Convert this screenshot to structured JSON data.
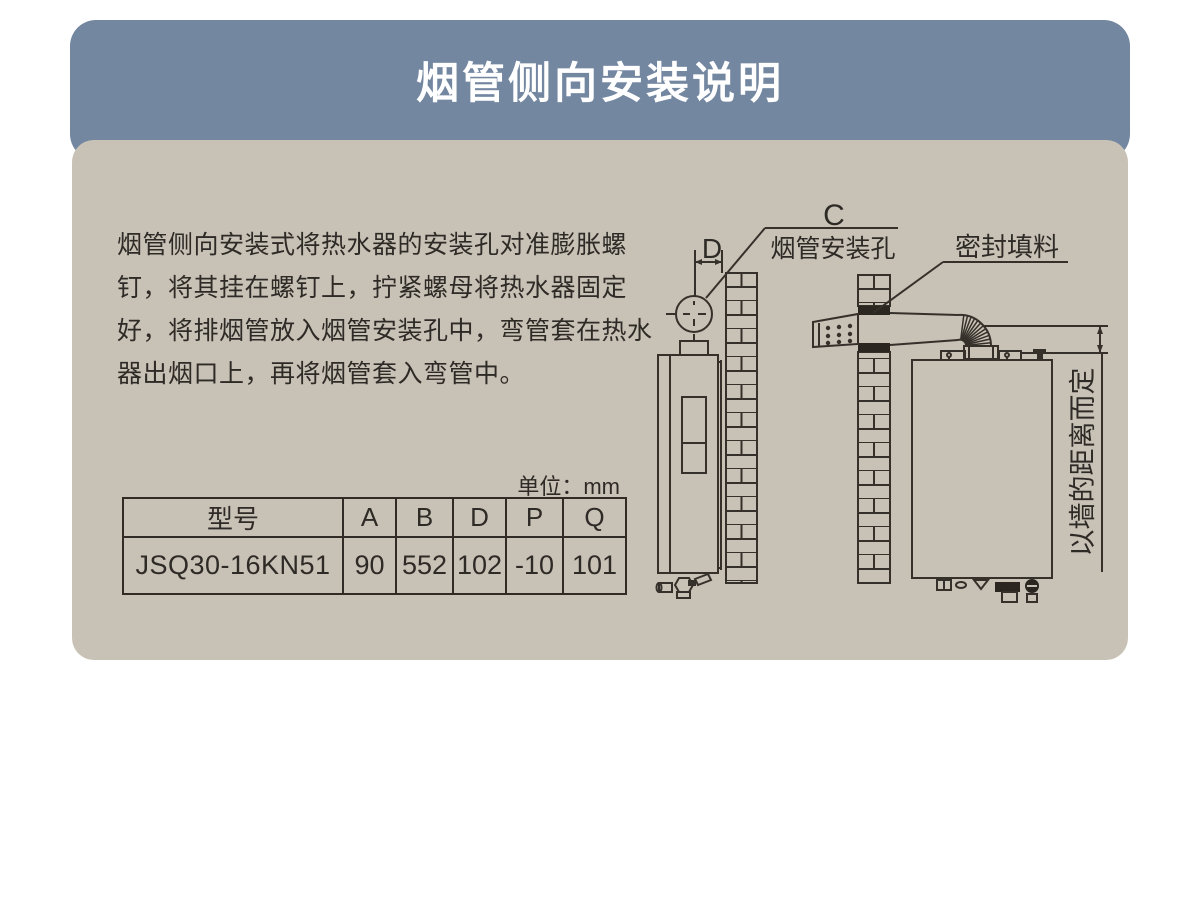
{
  "header": {
    "title": "烟管侧向安装说明",
    "background": "#7487a1",
    "text_color": "#ffffff"
  },
  "body_panel": {
    "background": "#c8c1b6"
  },
  "instructions": "烟管侧向安装式将热水器的安装孔对准膨胀螺钉，将其挂在螺钉上，拧紧螺母将热水器固定好，将排烟管放入烟管安装孔中，弯管套在热水器出烟口上，再将烟管套入弯管中。",
  "spec_table": {
    "unit_label": "单位：mm",
    "columns": [
      "型号",
      "A",
      "B",
      "D",
      "P",
      "Q"
    ],
    "rows": [
      {
        "model": "JSQ30-16KN51",
        "A": "90",
        "B": "552",
        "D": "102",
        "P": "-10",
        "Q": "101"
      }
    ]
  },
  "diagrams": {
    "left": {
      "dim_label_d": "D",
      "dim_label_c": "C",
      "hole_label": "烟管安装孔"
    },
    "right": {
      "seal_label": "密封填料",
      "distance_label": "以墙的距离而定"
    },
    "line_color": "#35302a"
  }
}
